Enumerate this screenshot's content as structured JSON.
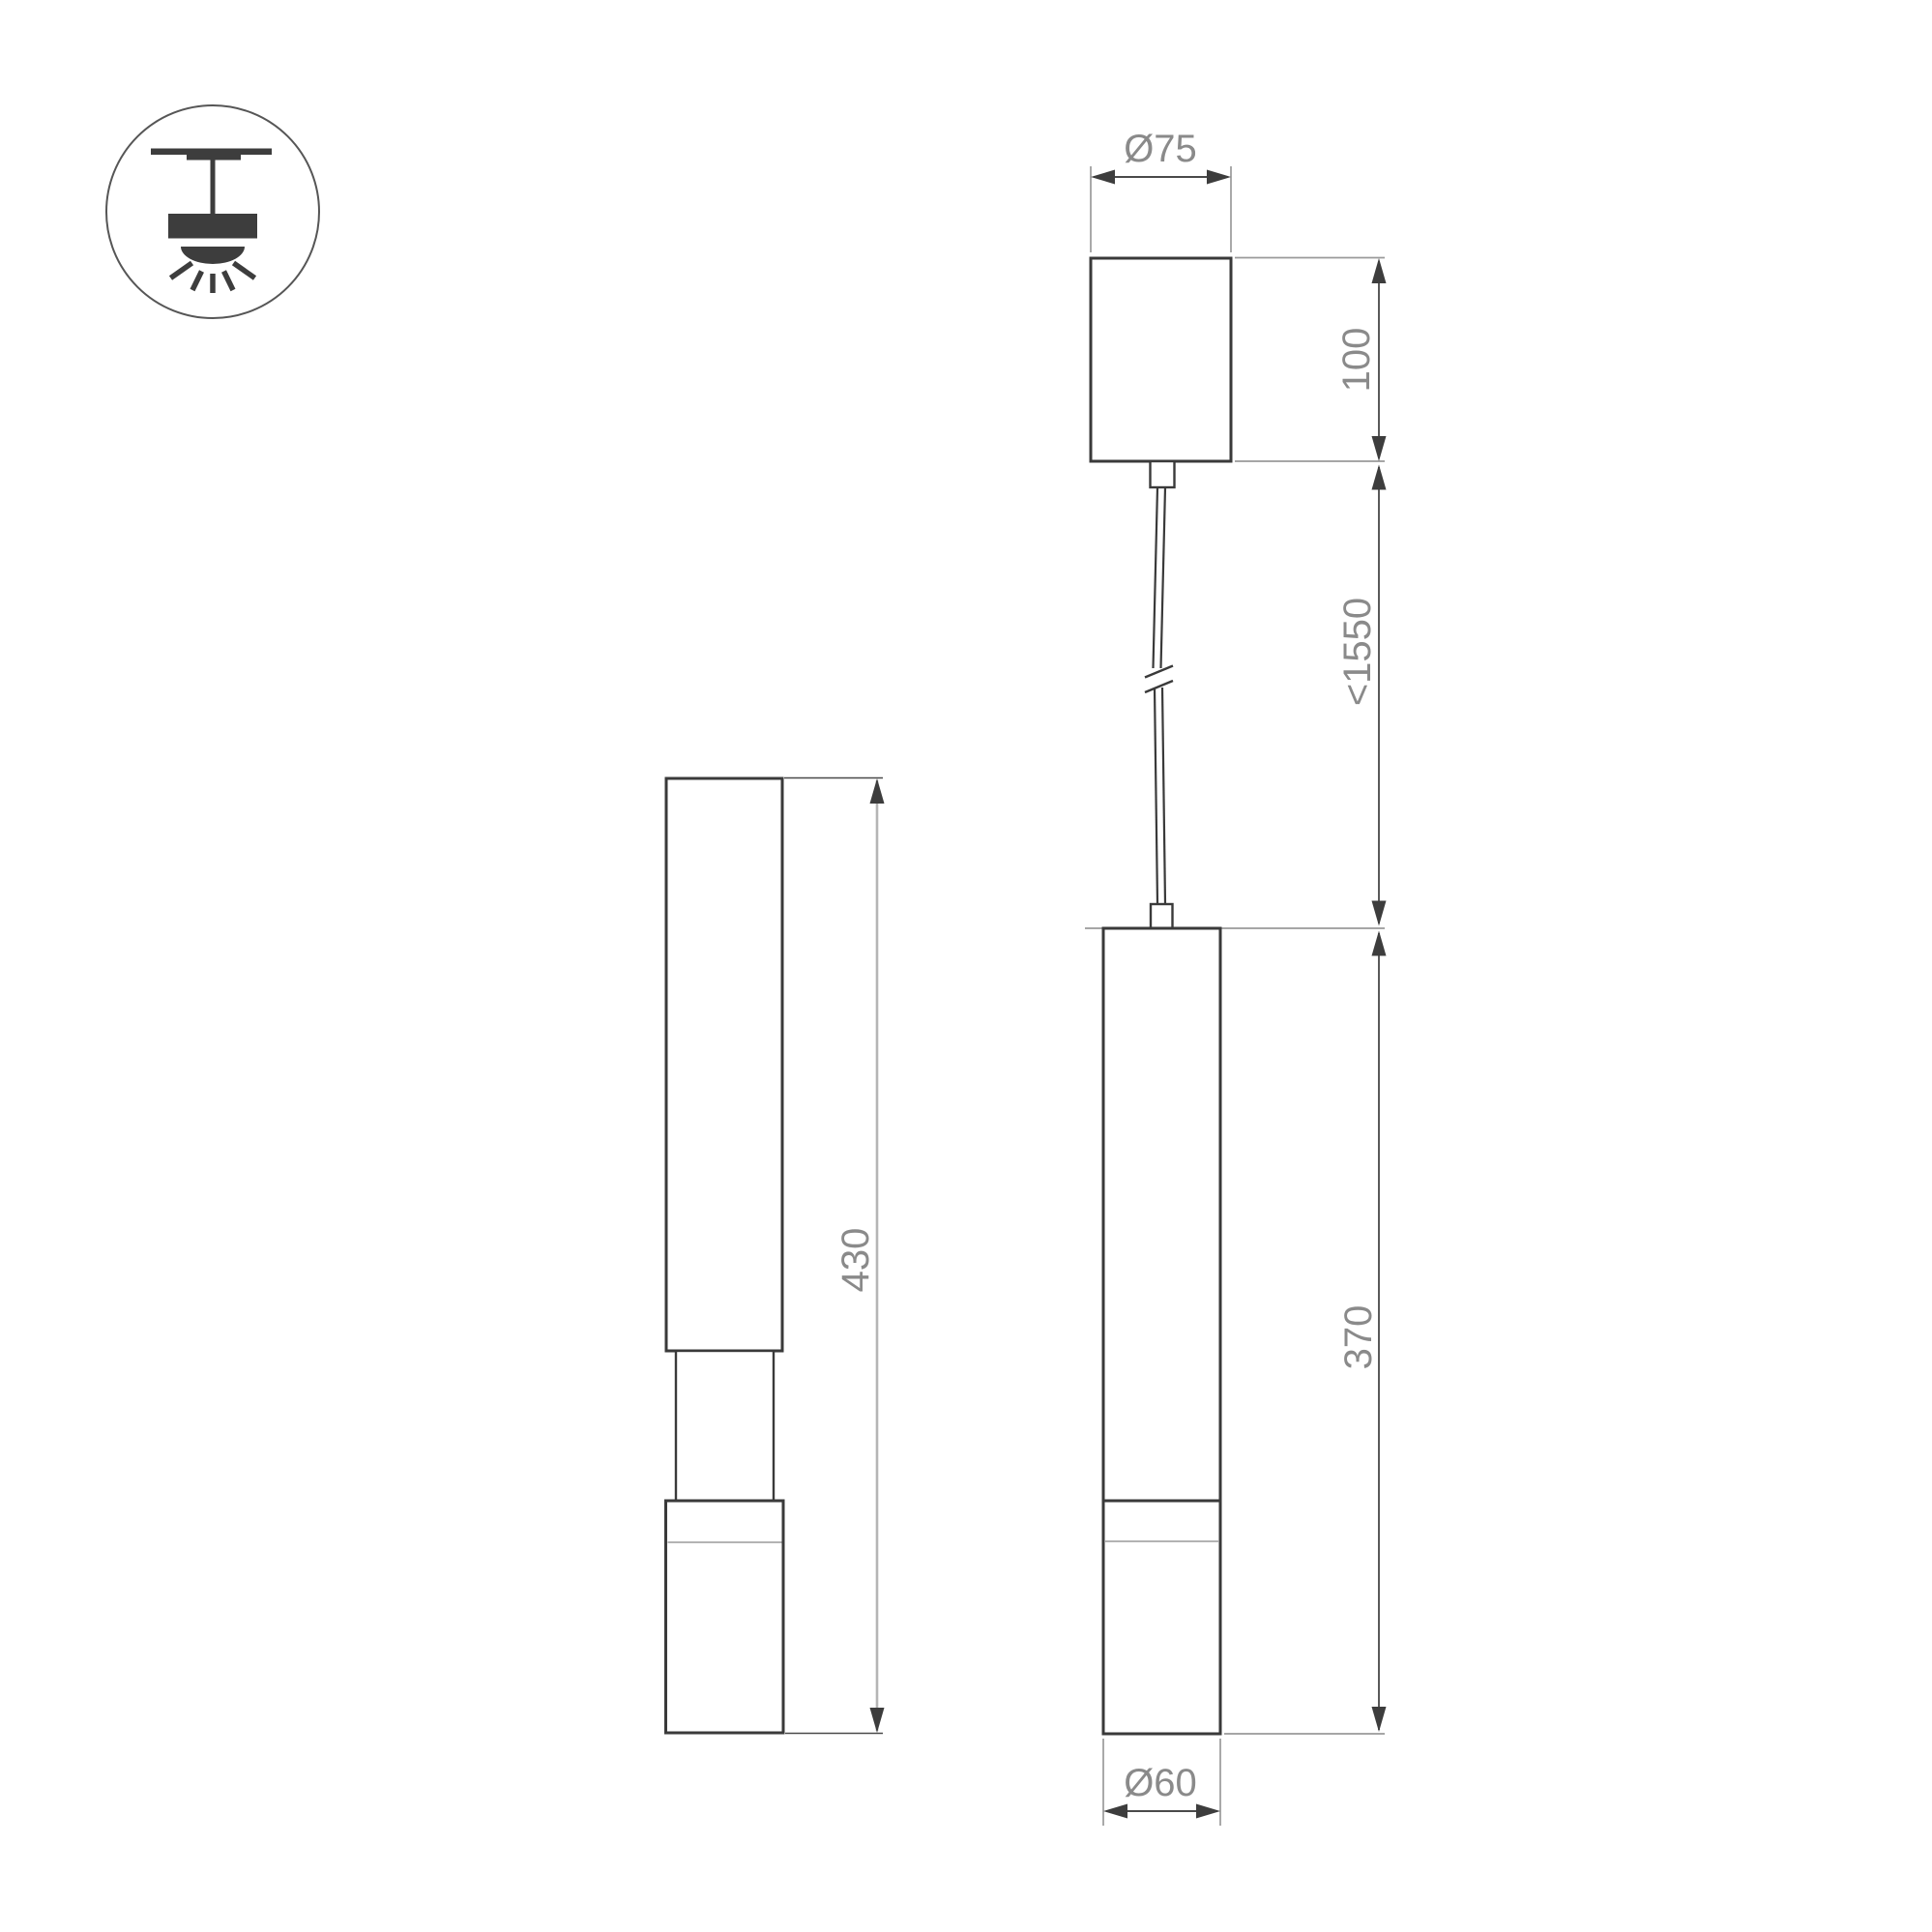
{
  "icon": {
    "name": "ceiling-pendant-mount-icon"
  },
  "labels": {
    "canopy_diameter": "Ø75",
    "canopy_height": "100",
    "suspension_length": "<1550",
    "body_height": "370",
    "body_diameter": "Ø60",
    "side_view_height": "430"
  },
  "colors": {
    "outline": "#3a3a3a",
    "arrow": "#3d3d3d",
    "dimension_line": "#5a5a5a",
    "dimension_line_light": "#b5b5b5",
    "extension_line": "#9a9a9a",
    "label_text": "#8a8a8a",
    "background": "#ffffff"
  }
}
